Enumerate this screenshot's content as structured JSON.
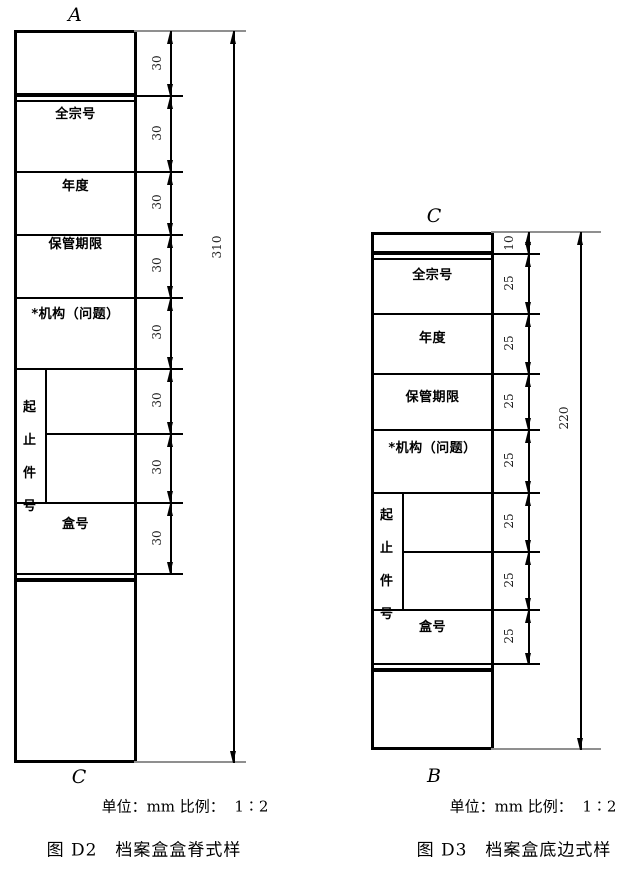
{
  "colors": {
    "line": "#000000",
    "extension_gray": "#8f8f8f",
    "dim_text": "#222222"
  },
  "figures": [
    {
      "id": "D2",
      "top_corner_label": "A",
      "bottom_corner_label": "C",
      "fields": {
        "fonds_no": "全宗号",
        "year": "年度",
        "retention": "保管期限",
        "org_issue": "*机构（问题）",
        "box_no": "盒号"
      },
      "vertical_field_chars": [
        "起",
        "止",
        "件",
        "号"
      ],
      "segment_dims": [
        "30",
        "30",
        "30",
        "30",
        "30",
        "30",
        "30",
        "30"
      ],
      "total_dim": "310",
      "unit_scale_note": "单位：mm 比例：  1∶2",
      "caption": "图 D2　档案盒盒脊式样"
    },
    {
      "id": "D3",
      "top_corner_label": "C",
      "bottom_corner_label": "B",
      "fields": {
        "fonds_no": "全宗号",
        "year": "年度",
        "retention": "保管期限",
        "org_issue": "*机构（问题）",
        "box_no": "盒号"
      },
      "vertical_field_chars": [
        "起",
        "止",
        "件",
        "号"
      ],
      "segment_dims": [
        "10",
        "25",
        "25",
        "25",
        "25",
        "25",
        "25",
        "25"
      ],
      "total_dim": "220",
      "unit_scale_note": "单位：mm 比例：  1∶2",
      "caption": "图 D3　档案盒底边式样"
    }
  ]
}
